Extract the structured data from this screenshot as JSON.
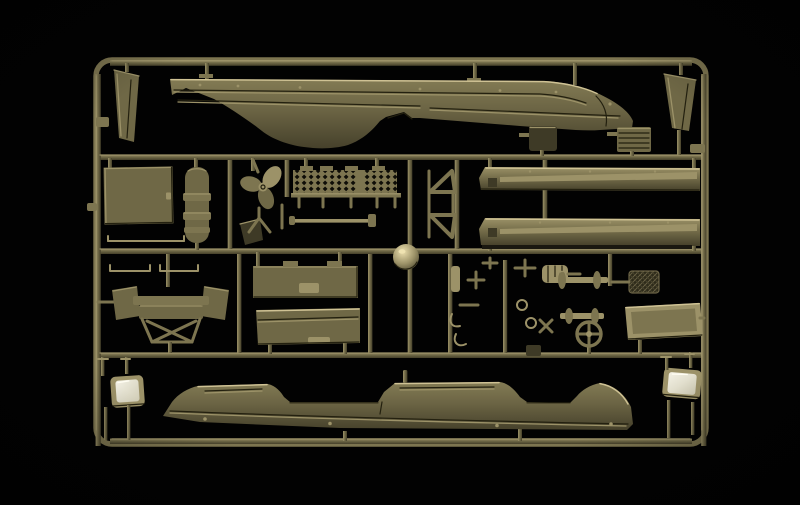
{
  "scene": {
    "description": "Studio product photograph of an injection-molded plastic model kit sprue (parts tree) shot against a black background",
    "subject": "Olive-drab styrene sprue holding amphibious truck (DUKW-style) hull halves, planks, panels, propeller, wheel, axles and small fittings",
    "material": "olive drab styrene plastic",
    "background": "black seamless studio backdrop"
  },
  "palette": {
    "background": "#020202",
    "sprue_base": "#6f6846",
    "sprue_mid": "#7d7550",
    "sprue_light": "#9c9268",
    "sprue_highlight": "#cfc294",
    "sprue_dark": "#45402a",
    "sprue_shadow": "#23200f",
    "part_dark": "#3e3a26",
    "glass_light": "#f4f2e6",
    "glass_dark": "#cfcbb4",
    "hull_top": "#837b54",
    "hull_mid": "#6b6444",
    "hull_bottom": "#46412b",
    "mesh_hole": "#0e0d07"
  },
  "parts": [
    {
      "id": "upper-hull",
      "label": "Upper hull half"
    },
    {
      "id": "lower-hull",
      "label": "Lower hull half"
    },
    {
      "id": "left-fin",
      "label": "Wedge fin part, top left"
    },
    {
      "id": "right-fin",
      "label": "Wedge fin part, top right"
    },
    {
      "id": "stowage-box",
      "label": "Dark stowage box"
    },
    {
      "id": "louver-panel",
      "label": "Small louvered panel"
    },
    {
      "id": "door-panel",
      "label": "Flat door panel"
    },
    {
      "id": "segmented-tank",
      "label": "Segmented pill-shaped tank"
    },
    {
      "id": "propeller",
      "label": "Three-blade propeller"
    },
    {
      "id": "mesh-grating",
      "label": "Mesh grating with legs"
    },
    {
      "id": "triangle-frames",
      "label": "Triangular frame brackets"
    },
    {
      "id": "side-plank-upper",
      "label": "Long side plank, upper"
    },
    {
      "id": "side-plank-lower",
      "label": "Long side plank, lower"
    },
    {
      "id": "tie-rod",
      "label": "Long tie rod"
    },
    {
      "id": "small-wedge",
      "label": "Small wedge plate"
    },
    {
      "id": "dome-hub",
      "label": "Polished dome hub"
    },
    {
      "id": "bench-seat",
      "label": "Bench seat with support frame"
    },
    {
      "id": "side-board-upper",
      "label": "Cargo side board, upper"
    },
    {
      "id": "side-board-lower",
      "label": "Cargo side board, lower"
    },
    {
      "id": "grab-rails",
      "label": "Thin grab rails"
    },
    {
      "id": "axle-front",
      "label": "Axle with hub flanges, front"
    },
    {
      "id": "axle-rear",
      "label": "Axle with hub flanges, rear"
    },
    {
      "id": "steering-wheel",
      "label": "Spoked steering wheel"
    },
    {
      "id": "muffler",
      "label": "Finned muffler"
    },
    {
      "id": "hatch-grille",
      "label": "Cross-hatched grille plate"
    },
    {
      "id": "windscreen-panel",
      "label": "Flat windscreen panel"
    },
    {
      "id": "window-frame-left",
      "label": "Window frame with clear glazing, bottom left"
    },
    {
      "id": "window-frame-right",
      "label": "Window frame with clear glazing, bottom right"
    },
    {
      "id": "small-fittings",
      "label": "Assorted small fittings cluster"
    }
  ]
}
